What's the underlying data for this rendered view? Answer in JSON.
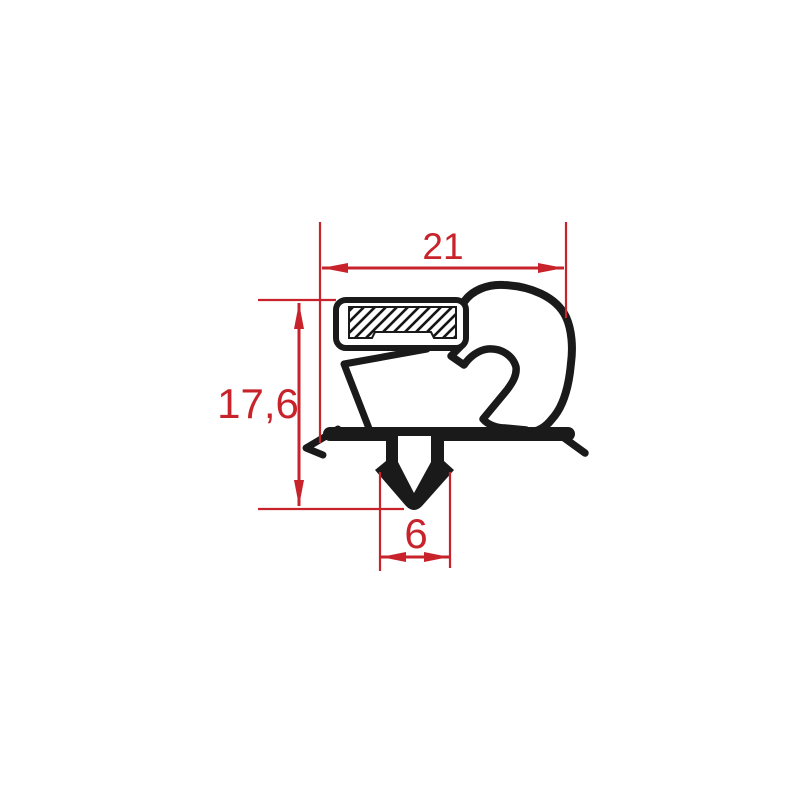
{
  "drawing": {
    "title": "Gasket profile cross-section with dimensions",
    "dims": {
      "width": {
        "label": "21",
        "orientation": "horizontal",
        "position": "top"
      },
      "height": {
        "label": "17,6",
        "orientation": "vertical",
        "position": "left"
      },
      "notch": {
        "label": "6",
        "orientation": "horizontal",
        "position": "bottom"
      }
    },
    "colors": {
      "dimension_red": "#c8232b",
      "profile_black": "#1a1a1a",
      "background": "#ffffff"
    }
  }
}
